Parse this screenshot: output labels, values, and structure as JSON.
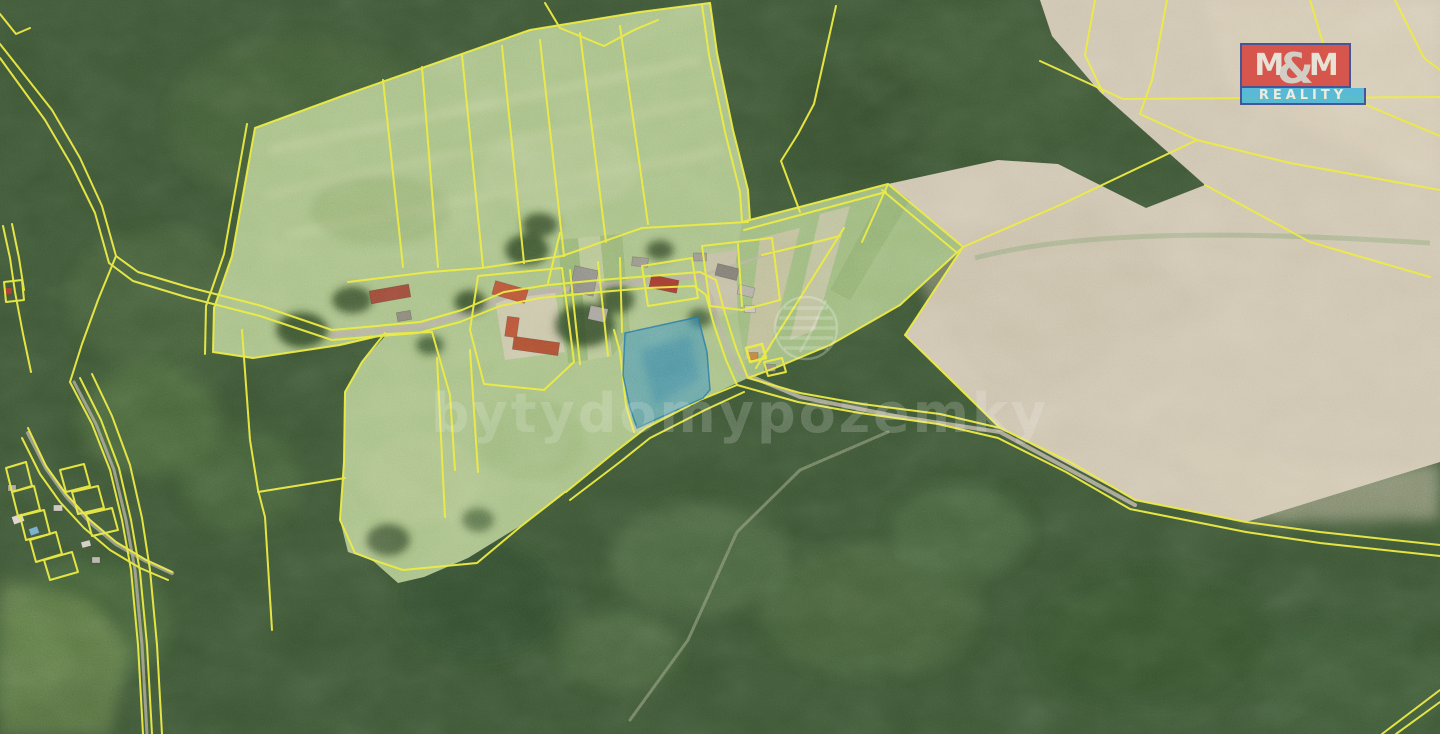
{
  "image": {
    "kind": "aerial-cadastral-map",
    "width_px": 1440,
    "height_px": 734
  },
  "watermark": {
    "text": "bytydomypozemky",
    "icon": "leaf-sphere-icon"
  },
  "brand_logo": {
    "m_left": "M",
    "ampersand": "&",
    "m_right": "M",
    "subtitle": "REALITY",
    "red": "#d6403a",
    "cyan": "#41b6dc",
    "border_navy": "#2a3f8f"
  },
  "map": {
    "highlighted_parcel": {
      "name": "offered-land-parcel",
      "fill": "#2f8cc0",
      "stroke": "#1d6fa3"
    },
    "colors": {
      "cadastral_line": "#eae93b",
      "forest": "#3c5434",
      "grass_field": "#a7bf85",
      "bare_field_beige": "#cdc3ae",
      "meadow": "#9fb87c",
      "road": "#b5af9f",
      "roof_terracotta": "#b75336",
      "roof_red": "#a03a2e",
      "roof_gray": "#8d8d85"
    }
  }
}
